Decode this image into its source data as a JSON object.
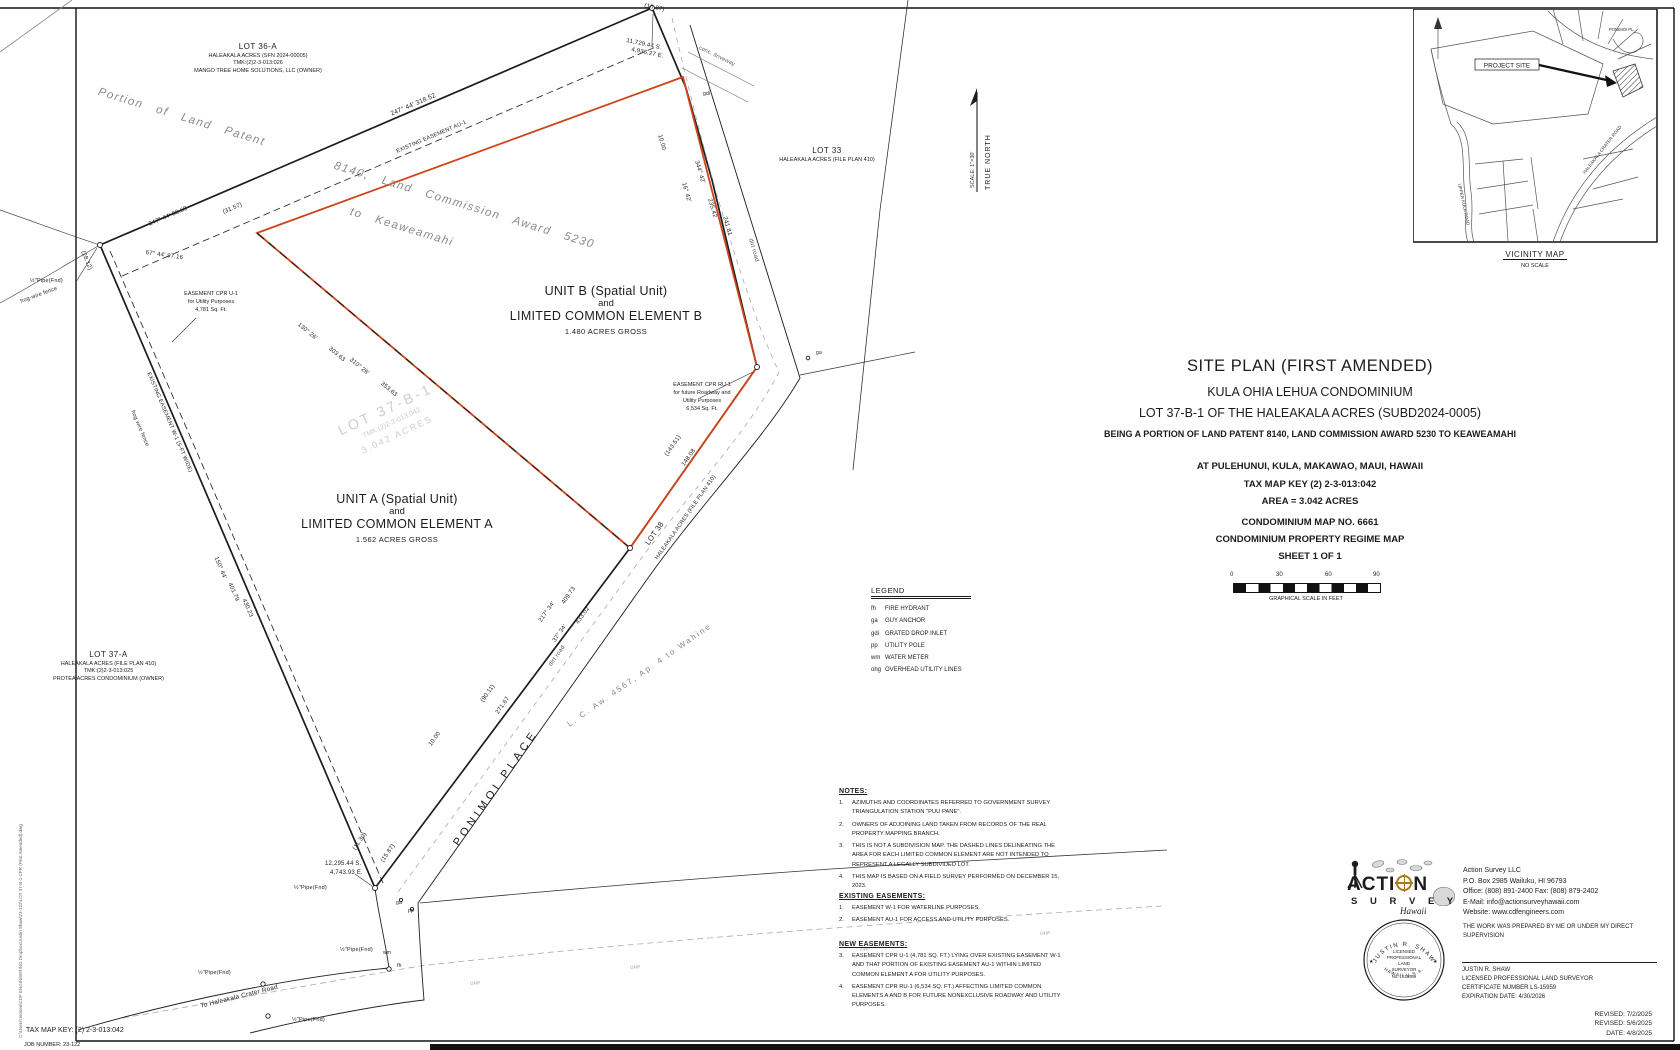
{
  "colors": {
    "ink": "#1c1c1c",
    "red": "#cf4318",
    "gray": "#8a8a8a",
    "watermark": "#cdcdcd"
  },
  "vicinity": {
    "title": "VICINITY MAP",
    "subtitle": "NO SCALE",
    "project_site": "PROJECT SITE",
    "roads": [
      "UPPER KULA ROAD",
      "HALEAKALA CRATER ROAD",
      "PONIMOI PL."
    ]
  },
  "north": {
    "label": "TRUE NORTH",
    "scale": "SCALE: 1\"=30'"
  },
  "titleblock": {
    "l1": "SITE PLAN (FIRST AMENDED)",
    "l2": "KULA OHIA LEHUA CONDOMINIUM",
    "l3": "LOT 37-B-1 OF THE HALEAKALA ACRES (SUBD2024-0005)",
    "l4": "BEING A PORTION OF LAND PATENT 8140, LAND COMMISSION AWARD 5230 TO KEAWEAMAHI",
    "l5": "AT PULEHUNUI, KULA, MAKAWAO, MAUI, HAWAII",
    "l6": "TAX MAP KEY (2) 2-3-013:042",
    "l7": "AREA = 3.042 ACRES",
    "l8": "CONDOMINIUM MAP NO. 6661",
    "l9": "CONDOMINIUM PROPERTY REGIME MAP",
    "l10": "SHEET 1 OF 1"
  },
  "scalebar": {
    "t0": "0",
    "t1": "30",
    "t2": "60",
    "t3": "90",
    "caption": "GRAPHICAL SCALE IN FEET"
  },
  "legend": {
    "title": "LEGEND",
    "items": [
      {
        "abbr": "fh",
        "text": "FIRE HYDRANT"
      },
      {
        "abbr": "ga",
        "text": "GUY ANCHOR"
      },
      {
        "abbr": "gdi",
        "text": "GRATED DROP INLET"
      },
      {
        "abbr": "pp",
        "text": "UTILITY POLE"
      },
      {
        "abbr": "wm",
        "text": "WATER METER"
      },
      {
        "abbr": "ohg",
        "text": "OVERHEAD UTILITY LINES"
      }
    ]
  },
  "notes": {
    "title": "NOTES:",
    "items": [
      {
        "num": "1.",
        "text": "AZIMUTHS AND COORDINATES REFERRED TO GOVERNMENT SURVEY TRIANGULATION STATION \"PUU PANE\"."
      },
      {
        "num": "2.",
        "text": "OWNERS OF ADJOINING LAND TAKEN FROM RECORDS OF THE REAL PROPERTY MAPPING BRANCH."
      },
      {
        "num": "3.",
        "text": "THIS IS NOT A SUBDIVISION MAP. THE DASHED LINES DELINEATING THE AREA FOR EACH LIMITED COMMON ELEMENT ARE NOT INTENDED TO REPRESENT A LEGALLY SUBDIVIDED LOT."
      },
      {
        "num": "4.",
        "text": "THIS MAP IS BASED ON A FIELD SURVEY PERFORMED ON DECEMBER 15, 2023."
      }
    ]
  },
  "existing_easements": {
    "title": "EXISTING EASEMENTS:",
    "items": [
      {
        "num": "1.",
        "text": "EASEMENT W-1 FOR WATERLINE PURPOSES."
      },
      {
        "num": "2.",
        "text": "EASEMENT AU-1 FOR ACCESS AND UTILITY PURPOSES."
      }
    ]
  },
  "new_easements": {
    "title": "NEW EASEMENTS:",
    "items": [
      {
        "num": "3.",
        "text": "EASEMENT CPR U-1 (4,781 SQ. FT.) LYING OVER EXISTING EASEMENT W-1 AND THAT PORTION OF EXISTING EASEMENT AU-1 WITHIN LIMITED COMMON ELEMENT A FOR UTILITY PURPOSES."
      },
      {
        "num": "4.",
        "text": "EASEMENT CPR RU-1 (6,534 SQ. FT.) AFFECTING LIMITED COMMON ELEMENTS A AND B FOR FUTURE NONEXCLUSIVE ROADWAY AND UTILITY PURPOSES."
      }
    ]
  },
  "firm": {
    "logo_part1": "ACTI",
    "logo_part2": "N",
    "logo_word2": "S U R V E Y",
    "logo_script": "Hawaii",
    "name": "Action Survey LLC",
    "address": "P.O. Box 2985 Wailuku, HI 96793",
    "phone": "Office: (808) 891-2400  Fax: (808) 879-2402",
    "email": "E-Mail: info@actionsurveyhawaii.com",
    "website": "Website: www.cdfengineers.com",
    "supervision": "THE WORK WAS PREPARED BY ME OR UNDER MY DIRECT SUPERVISION"
  },
  "surveyor": {
    "name": "JUSTIN R. SHAW",
    "title": "LICENSED PROFESSIONAL LAND SURVEYOR",
    "certificate": "CERTIFICATE NUMBER LS-15959",
    "expiration": "EXPIRATION DATE: 4/30/2026",
    "seal": {
      "top": "JUSTIN R. SHAW",
      "c0": "LICENSED",
      "c1": "PROFESSIONAL",
      "c2": "LAND",
      "c3": "SURVEYOR",
      "c4": "No. LS15959",
      "bottom": "HAWAII   U.S.A.",
      "star_l": "★",
      "star_r": "★"
    }
  },
  "revisions": [
    {
      "text": "REVISED: 7/2/2025"
    },
    {
      "text": "REVISED: 5/6/2025"
    },
    {
      "text": "DATE: 4/8/2025"
    }
  ],
  "footer": {
    "tax_map_key": "TAX MAP KEY: (2) 2-3-013:042",
    "job_number": "JOB NUMBER: 23-122",
    "file_path": "C:\\Users\\Jensen\\CDF ENGINEERING Dropbox\\Justin Shaw\\23-122\\LOT 37-B-1 CPR (First Amended).dwg"
  },
  "plat": {
    "lot36a": [
      "LOT 36-A",
      "HALEAKALA ACRES (SFN 2024-00005)",
      "TMK:(2)2-3-013:026",
      "MANGO TREE HOME SOLUTIONS, LLC (OWNER)"
    ],
    "lot33": [
      "LOT 33",
      "HALEAKALA ACRES (FILE PLAN 410)"
    ],
    "lot37a": [
      "LOT 37-A",
      "HALEAKALA ACRES (FILE PLAN 410)",
      "TMK:(2)2-3-013:025",
      "PROTEA ACRES CONDOMINIUM (OWNER)"
    ],
    "unit_b": [
      "UNIT B (Spatial Unit)",
      "and",
      "LIMITED COMMON ELEMENT B",
      "1.480 ACRES GROSS"
    ],
    "unit_a": [
      "UNIT A (Spatial Unit)",
      "and",
      "LIMITED COMMON ELEMENT A",
      "1.562 ACRES GROSS"
    ],
    "easement_u1": [
      "EASEMENT CPR U-1",
      "for Utility Purposes",
      "4,781 Sq. Ft."
    ],
    "easement_ru1": [
      "EASEMENT CPR RU-1",
      "for future Roadway and",
      "Utility Purposes",
      "6,534 Sq. Ft."
    ],
    "watermark": [
      "LOT 37-B-1",
      "TMK:(2)2-3-013:042",
      "3.042 ACRES"
    ],
    "patent": [
      "Portion  of  Land  Patent",
      "8140,  Land  Commission  Award  5230",
      "to  Keaweamahi"
    ],
    "labels": [
      {
        "n": "dim-topleft-1",
        "t": "247° 44'          318.52",
        "x": 390,
        "y": 112,
        "r": -23
      },
      {
        "n": "easement-au1-label",
        "t": "EXISTING EASEMENT AU-1",
        "x": 396,
        "y": 150,
        "r": -23,
        "f": 5.5
      },
      {
        "n": "dim-topleft-2",
        "t": "247° 44'       88.69",
        "x": 148,
        "y": 222,
        "r": -23,
        "f": 6
      },
      {
        "n": "dim-topleft-3",
        "t": "(31.57)",
        "x": 222,
        "y": 210,
        "r": -23,
        "f": 6
      },
      {
        "n": "dim-topleft-4",
        "t": "67° 44'       97.16",
        "x": 146,
        "y": 250,
        "r": 8,
        "f": 6
      },
      {
        "n": "dim-west-1",
        "t": "(28.12)",
        "x": 85,
        "y": 250,
        "r": 67,
        "f": 6
      },
      {
        "n": "pipe-found-1",
        "t": "½\"Pipe(Fnd)",
        "x": 30,
        "y": 279,
        "f": 5.5
      },
      {
        "n": "fence-label-1",
        "t": "hog-wire fence",
        "x": 20,
        "y": 300,
        "r": -20,
        "f": 5.5
      },
      {
        "n": "easement-w1-label",
        "t": "EXISTING EASEMENT W-1 (5-FT WIDE)",
        "x": 150,
        "y": 372,
        "r": 67,
        "f": 5.5
      },
      {
        "n": "fence-label-2",
        "t": "hog wire fence",
        "x": 134,
        "y": 410,
        "r": 67,
        "f": 5.5
      },
      {
        "n": "dim-west-2",
        "t": "150° 44'",
        "x": 218,
        "y": 556,
        "r": 67,
        "f": 6
      },
      {
        "n": "dim-west-3",
        "t": "401.79",
        "x": 232,
        "y": 582,
        "r": 67,
        "f": 6
      },
      {
        "n": "dim-west-4",
        "t": "430.23",
        "x": 246,
        "y": 598,
        "r": 67,
        "f": 6
      },
      {
        "n": "dim-east-1",
        "t": "10.00",
        "x": 662,
        "y": 134,
        "r": 74,
        "f": 6
      },
      {
        "n": "dim-east-2",
        "t": "344° 42'",
        "x": 699,
        "y": 160,
        "r": 74,
        "f": 6
      },
      {
        "n": "dim-east-3",
        "t": "16° 42'",
        "x": 686,
        "y": 182,
        "r": 74,
        "f": 6
      },
      {
        "n": "dim-east-4",
        "t": "235.42",
        "x": 712,
        "y": 198,
        "r": 74,
        "f": 6
      },
      {
        "n": "dim-east-5",
        "t": "241.81",
        "x": 727,
        "y": 216,
        "r": 74,
        "f": 6
      },
      {
        "n": "road-label-dirt-2",
        "t": "dirt road",
        "x": 753,
        "y": 238,
        "r": 74,
        "f": 6,
        "c": "#555555"
      },
      {
        "n": "driveway-label",
        "t": "conc. driveway",
        "x": 700,
        "y": 46,
        "r": 26,
        "f": 5.5,
        "c": "#555555"
      },
      {
        "n": "marker-gdi",
        "t": "gdi",
        "x": 703,
        "y": 92,
        "f": 5
      },
      {
        "n": "dim-se-1",
        "t": "(143.51)",
        "x": 664,
        "y": 454,
        "r": -55,
        "f": 6
      },
      {
        "n": "dim-se-2",
        "t": "148.08",
        "x": 681,
        "y": 464,
        "r": -55,
        "f": 6
      },
      {
        "n": "lot38-label-1",
        "t": "LOT  38",
        "x": 644,
        "y": 542,
        "r": -55,
        "f": 7.5
      },
      {
        "n": "lot38-label-2",
        "t": "HALEAKALA ACRES (FILE PLAN 410)",
        "x": 655,
        "y": 558,
        "r": -55,
        "f": 5.5
      },
      {
        "n": "road-ponimoi-label",
        "t": "PONIMOI   PLACE",
        "x": 452,
        "y": 842,
        "r": -55,
        "f": 11,
        "s": 4
      },
      {
        "n": "road-label-dirt-1",
        "t": "dirt road",
        "x": 548,
        "y": 664,
        "r": -55,
        "f": 6,
        "c": "#555555"
      },
      {
        "n": "dim-road-1",
        "t": "217° 34'",
        "x": 538,
        "y": 620,
        "r": -55,
        "f": 6
      },
      {
        "n": "dim-road-2",
        "t": "409.73",
        "x": 561,
        "y": 602,
        "r": -55,
        "f": 6
      },
      {
        "n": "dim-road-3",
        "t": "37° 34'",
        "x": 552,
        "y": 640,
        "r": -55,
        "f": 6
      },
      {
        "n": "dim-road-4",
        "t": "433.02",
        "x": 575,
        "y": 622,
        "r": -55,
        "f": 6
      },
      {
        "n": "dim-road-5",
        "t": "(90.11)",
        "x": 480,
        "y": 700,
        "r": -55,
        "f": 6
      },
      {
        "n": "dim-road-6",
        "t": "271.67",
        "x": 495,
        "y": 712,
        "r": -55,
        "f": 6
      },
      {
        "n": "dim-road-7",
        "t": "10.00",
        "x": 428,
        "y": 744,
        "r": -55,
        "f": 6
      },
      {
        "n": "dim-diag-1",
        "t": "130° 26'",
        "x": 300,
        "y": 322,
        "r": 40,
        "f": 6
      },
      {
        "n": "dim-diag-2",
        "t": "303.63",
        "x": 331,
        "y": 346,
        "r": 40,
        "f": 6
      },
      {
        "n": "dim-diag-3",
        "t": "310° 26'",
        "x": 352,
        "y": 357,
        "r": 40,
        "f": 6
      },
      {
        "n": "dim-diag-4",
        "t": "353.63",
        "x": 383,
        "y": 381,
        "r": 40,
        "f": 6
      },
      {
        "n": "coord-north-1",
        "t": "11,729.44  S.",
        "x": 627,
        "y": 38,
        "r": 12,
        "f": 6
      },
      {
        "n": "coord-north-2",
        "t": "4,936.27  E.",
        "x": 632,
        "y": 47,
        "r": 12,
        "f": 6
      },
      {
        "n": "dim-apex",
        "t": "(10.07)",
        "x": 645,
        "y": 3,
        "r": 12,
        "f": 6
      },
      {
        "n": "coord-south-1",
        "t": "12,295.44  S.",
        "x": 325,
        "y": 861,
        "f": 6
      },
      {
        "n": "coord-south-2",
        "t": "4,743.93  E.",
        "x": 330,
        "y": 870,
        "f": 6
      },
      {
        "n": "dim-south-1",
        "t": "(11.30)",
        "x": 352,
        "y": 848,
        "r": -55,
        "f": 6
      },
      {
        "n": "dim-south-2",
        "t": "(15.87)",
        "x": 380,
        "y": 860,
        "r": -55,
        "f": 6
      },
      {
        "n": "pipe-found-2",
        "t": "½\"Pipe(Fnd)",
        "x": 294,
        "y": 886,
        "f": 5.5
      },
      {
        "n": "pipe-found-3",
        "t": "½\"Pipe(Fnd)",
        "x": 198,
        "y": 971,
        "f": 5.5
      },
      {
        "n": "pipe-found-4",
        "t": "½\"Pipe(Fnd)",
        "x": 292,
        "y": 1018,
        "f": 5.5
      },
      {
        "n": "pipe-found-5",
        "t": "½\"Pipe(Fnd)",
        "x": 340,
        "y": 948,
        "f": 5.5
      },
      {
        "n": "marker-wm",
        "t": "wm",
        "x": 383,
        "y": 951,
        "f": 5
      },
      {
        "n": "marker-fh",
        "t": "fh",
        "x": 397,
        "y": 964,
        "f": 5
      },
      {
        "n": "marker-ga-1",
        "t": "ga",
        "x": 396,
        "y": 901,
        "f": 5
      },
      {
        "n": "marker-pp-1",
        "t": "pp",
        "x": 408,
        "y": 909,
        "f": 5
      },
      {
        "n": "marker-ga-2",
        "t": "ga",
        "x": 816,
        "y": 351,
        "f": 5
      },
      {
        "n": "marker-ohp-1",
        "t": "OHP",
        "x": 470,
        "y": 982,
        "r": -4,
        "f": 4.5,
        "c": "#999999"
      },
      {
        "n": "marker-ohp-2",
        "t": "OHP",
        "x": 630,
        "y": 966,
        "r": -4,
        "f": 4.5,
        "c": "#999999"
      },
      {
        "n": "marker-ohp-3",
        "t": "OHP",
        "x": 860,
        "y": 948,
        "r": -4,
        "f": 4.5,
        "c": "#999999"
      },
      {
        "n": "marker-ohp-4",
        "t": "OHP",
        "x": 1040,
        "y": 932,
        "r": -4,
        "f": 4.5,
        "c": "#999999"
      },
      {
        "n": "road-to-haleakala",
        "t": "To Haleakala Crater Road",
        "x": 200,
        "y": 1004,
        "r": -14,
        "f": 6.5
      },
      {
        "n": "lca-4567-label",
        "t": "L.  C.  Aw.  4567,  Ap.  4  to  Wahine",
        "x": 566,
        "y": 722,
        "r": -35,
        "f": 8,
        "c": "#888888",
        "s": 2
      }
    ]
  }
}
